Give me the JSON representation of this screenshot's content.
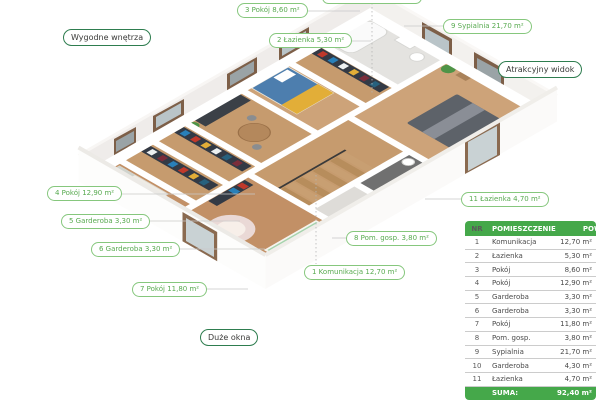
{
  "colors": {
    "accent_green": "#45a84a",
    "pill_room_border": "#86c77d",
    "pill_room_text": "#58aa50",
    "pill_feature_border": "#2e7d4f",
    "wood_floor": "#c69b6e",
    "wall_white": "#ffffff",
    "bath_dark_floor": "#707070"
  },
  "feature_labels": [
    {
      "text": "Wygodne wnętrza"
    },
    {
      "text": "Atrakcyjny widok"
    },
    {
      "text": "Duże okna"
    }
  ],
  "room_labels": [
    {
      "text": "3 Pokój 8,60 m²"
    },
    {
      "text": "2 Łazienka 5,30 m²"
    },
    {
      "text": "9 Sypialnia 21,70 m²"
    },
    {
      "text": "4 Pokój 12,90 m²"
    },
    {
      "text": "5 Garderoba 3,30 m²"
    },
    {
      "text": "6 Garderoba 3,30 m²"
    },
    {
      "text": "7 Pokój 11,80 m²"
    },
    {
      "text": "8 Pom. gosp. 3,80 m²"
    },
    {
      "text": "1 Komunikacja 12,70 m²"
    },
    {
      "text": "11 Łazienka 4,70 m²"
    }
  ],
  "table": {
    "headers": {
      "nr": "NR",
      "name": "POMIESZCZENIE",
      "pow": "POW."
    },
    "rows": [
      {
        "nr": "1",
        "name": "Komunikacja",
        "pow": "12,70 m²"
      },
      {
        "nr": "2",
        "name": "Łazienka",
        "pow": "5,30 m²"
      },
      {
        "nr": "3",
        "name": "Pokój",
        "pow": "8,60 m²"
      },
      {
        "nr": "4",
        "name": "Pokój",
        "pow": "12,90 m²"
      },
      {
        "nr": "5",
        "name": "Garderoba",
        "pow": "3,30 m²"
      },
      {
        "nr": "6",
        "name": "Garderoba",
        "pow": "3,30 m²"
      },
      {
        "nr": "7",
        "name": "Pokój",
        "pow": "11,80 m²"
      },
      {
        "nr": "8",
        "name": "Pom. gosp.",
        "pow": "3,80 m²"
      },
      {
        "nr": "9",
        "name": "Sypialnia",
        "pow": "21,70 m²"
      },
      {
        "nr": "10",
        "name": "Garderoba",
        "pow": "4,30 m²"
      },
      {
        "nr": "11",
        "name": "Łazienka",
        "pow": "4,70 m²"
      }
    ],
    "suma_label": "SUMA:",
    "suma_value": "92,40 m²"
  }
}
